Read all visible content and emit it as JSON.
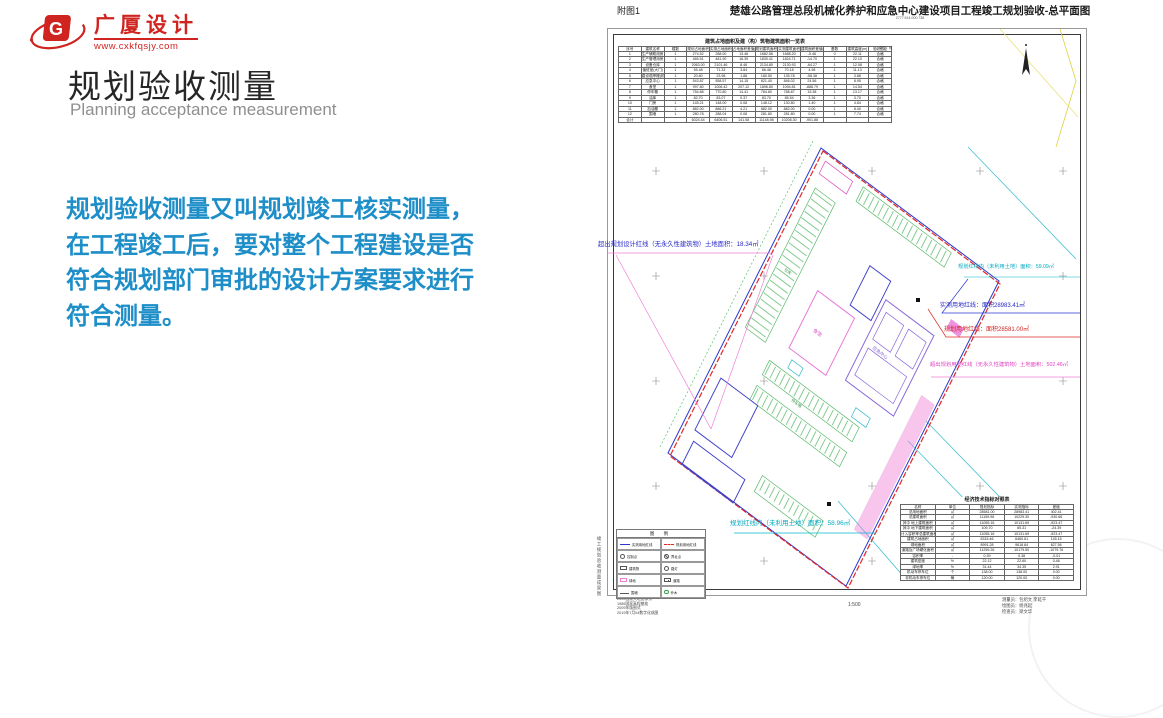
{
  "slide": {
    "logo": {
      "brand": "广厦设计",
      "url": "www.cxkfqsjy.com"
    },
    "title": "规划验收测量",
    "subtitle": "Planning acceptance measurement",
    "body": "规划验收测量又叫规划竣工核实测量，\n在工程竣工后，要对整个工程建设是否\n符合规划部门审批的设计方案要求进行\n符合测量。"
  },
  "drawing": {
    "figure_label": "附图1",
    "title": "楚雄公路管理总段机械化养护和应急中心建设项目工程竣工规划验收-总平面图",
    "title_sub": "2777.914-000.738",
    "side_label": "竣工规划验收测量成果图",
    "scale": "1:500"
  },
  "annotations": {
    "left_overrun": "超出规划设计红线（无永久性建筑物）土地面积：18.34㎡",
    "unused_right": "规划红线内（未利用土地）面积：59.09㎡",
    "measured_redline": "实测用地红线：面积28983.41㎡",
    "planned_redline": "规划用地红线：面积28581.00㎡",
    "overrun_south": "超出规划用地红线（无永久性建筑物）土地面积：502.46㎡",
    "unused_bottom": "规划红线内（未利用土地）面积：58.96㎡"
  },
  "plan": {
    "labels": [
      "食堂",
      "应急中心",
      "停车棚",
      "仓库"
    ]
  },
  "area_table": {
    "title": "建筑占地面积及建（构）筑物建筑面积一览表",
    "unit_note": "单位：㎡",
    "headers": [
      "序号",
      "建筑名称",
      "幢数",
      "规划占地面积(㎡)",
      "实测占地面积(㎡)",
      "占地面积差值(㎡)",
      "规划建筑面积(㎡)",
      "实测建筑面积(㎡)",
      "建筑面积差值(实测-规划)",
      "基数",
      "建筑高度(m)",
      "验收结论"
    ],
    "rows": [
      [
        "1",
        "生产辅助用房",
        "1",
        "274.52",
        "288.00",
        "13.48",
        "1682.56",
        "1688.20",
        "-5.46",
        "0",
        "22.11",
        "合格"
      ],
      [
        "2",
        "生产管理用房",
        "1",
        "465.51",
        "481.90",
        "16.39",
        "1830.41",
        "1824.71",
        "-14.70",
        "1",
        "22.10",
        "合格"
      ],
      [
        "3",
        "设备仓库",
        "1",
        "2063.00",
        "2101.46",
        "8.46",
        "2134.80",
        "2130.93",
        "-64.27",
        "1",
        "12.08",
        "合格"
      ],
      [
        "4",
        "值班室(大门)",
        "1",
        "55.48",
        "71.33",
        "3.84",
        "66.48",
        "70.18",
        "4.98",
        "1",
        "11.13",
        "合格"
      ],
      [
        "5",
        "建设观摩棚(机修车间)",
        "1",
        "20.80",
        "23.98",
        "1.88",
        "180.50",
        "135.78",
        "-58.38",
        "1",
        "3.88",
        "合格"
      ],
      [
        "6",
        "应急中心",
        "1",
        "543.87",
        "558.57",
        "14.15",
        "821.40",
        "846.02",
        "24.56",
        "1",
        "8.95",
        "合格"
      ],
      [
        "7",
        "食堂",
        "1",
        "997.80",
        "1006.42",
        "207.12",
        "1896.80",
        "1094.81",
        "-888.79",
        "1",
        "14.54",
        "合格"
      ],
      [
        "8",
        "停车棚",
        "1",
        "754.88",
        "770.80",
        "14.41",
        "784.80",
        "788.87",
        "15.38",
        "1",
        "13.17",
        "合格"
      ],
      [
        "9",
        "油库",
        "1",
        "82.70",
        "83.07",
        "0.37",
        "83.70",
        "85.54",
        "3.36",
        "1",
        "3.70",
        "合格"
      ],
      [
        "10",
        "门房",
        "1",
        "145.21",
        "148.00",
        "0.08",
        "148.12",
        "130.80",
        "1.40",
        "1",
        "4.84",
        "合格"
      ],
      [
        "11",
        "加油棚",
        "1",
        "882.00",
        "886.21",
        "4.21",
        "882.00",
        "882.00",
        "0.00",
        "1",
        "8.40",
        "合格"
      ],
      [
        "12",
        "围墙",
        "1",
        "280.78",
        "288.04",
        "0.08",
        "281.80",
        "281.80",
        "0.00",
        "1",
        "7.74",
        "合格"
      ],
      [
        "合计",
        "",
        "",
        "6024.44",
        "6406.51",
        "141.08",
        "11148.98",
        "10208.30",
        "-901.88",
        "",
        "",
        ""
      ]
    ]
  },
  "econ_table": {
    "title": "经济技术指标对照表",
    "headers": [
      "名称",
      "单位",
      "规划指标",
      "实测指标",
      "差值"
    ],
    "rows": [
      [
        "总用地面积",
        "㎡",
        "28581.00",
        "28983.41",
        "402.41"
      ],
      [
        "总建筑面积",
        "㎡",
        "11159.96",
        "10229.30",
        "-930.66"
      ],
      [
        "其中 地上建筑面积",
        "㎡",
        "11055.16",
        "10131.69",
        "-923.47"
      ],
      [
        "其中 地下建筑面积",
        "㎡",
        "109.70",
        "85.31",
        "-24.39"
      ],
      [
        "计入容积率总建筑面积",
        "㎡",
        "11055.16",
        "10131.69",
        "-923.47"
      ],
      [
        "建筑占地面积",
        "㎡",
        "6315.46",
        "6460.61",
        "145.15"
      ],
      [
        "绿地面积",
        "㎡",
        "8991.28",
        "9618.84",
        "627.56"
      ],
      [
        "道路及广场硬化面积",
        "㎡",
        "11259.26",
        "10179.50",
        "-1079.76"
      ],
      [
        "容积率",
        "-",
        "0.39",
        "0.38",
        "-0.01"
      ],
      [
        "建筑密度",
        "%",
        "22.12",
        "22.60",
        "0.48"
      ],
      [
        "绿地率",
        "%",
        "31.44",
        "34.35",
        "2.91"
      ],
      [
        "机动车停车位",
        "个",
        "138.00",
        "138.00",
        "0.00"
      ],
      [
        "非机动车停车位",
        "辆",
        "120.00",
        "120.00",
        "0.00"
      ]
    ]
  },
  "legend": {
    "title": "图  例",
    "items": [
      {
        "label": "实测用地红线"
      },
      {
        "label": "规划用地红线"
      },
      {
        "label": "控制点"
      },
      {
        "label": "界址点"
      },
      {
        "label": "建筑物"
      },
      {
        "label": "路灯"
      },
      {
        "label": "绿地"
      },
      {
        "label": "道路"
      },
      {
        "label": "围墙"
      },
      {
        "label": "乔木"
      }
    ]
  },
  "footer": {
    "datum": "2000国家大地坐标系\n1985国家高程基准\n2009年版图式\n2019年7月04数字化成图",
    "scale": "1:500",
    "credits": "测量员：包绍文 李延千\n绘图员：杨兆起\n检查员：梁文华"
  }
}
